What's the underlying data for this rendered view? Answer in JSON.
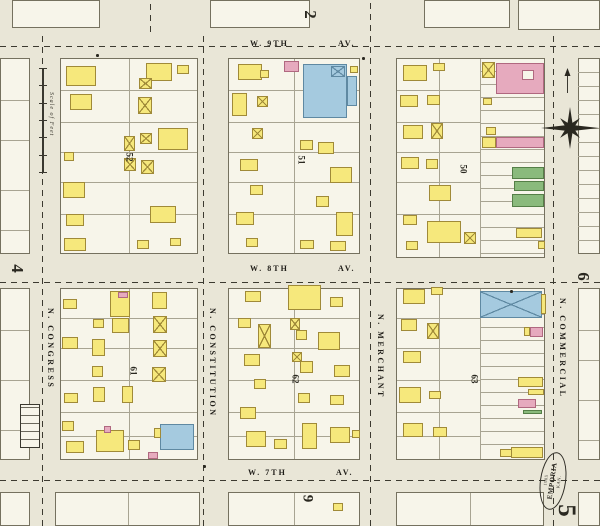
{
  "page": {
    "bg": "#e9e6d7",
    "block_fill": "#f7f5ea",
    "block_line": "#75715f",
    "lot_line": "#a8a492",
    "dash": "#3c3a30",
    "ink": "#2a2820",
    "building_colors": {
      "f": {
        "name": "frame",
        "fill": "#f6e87c",
        "border": "#a08a38"
      },
      "b": {
        "name": "brick",
        "fill": "#e6aabe",
        "border": "#b06880"
      },
      "s": {
        "name": "stone",
        "fill": "#a5cadf",
        "border": "#5f89a2"
      },
      "g": {
        "name": "special",
        "fill": "#8aba7c",
        "border": "#557f47"
      },
      "w": {
        "name": "courtyard",
        "fill": "#f7f5ea",
        "border": "#b06880"
      }
    }
  },
  "streets": {
    "horizontal": [
      {
        "name": "W. 9TH",
        "suffix": "AV.",
        "label_x": 250,
        "suffix_x": 338,
        "label_y": 39,
        "dash_y": 46
      },
      {
        "name": "W. 8TH",
        "suffix": "AV.",
        "label_x": 250,
        "suffix_x": 338,
        "label_y": 264,
        "dash_y": 282
      },
      {
        "name": "W. 7TH",
        "suffix": "AV.",
        "label_x": 248,
        "suffix_x": 336,
        "label_y": 468,
        "dash_y": 480
      }
    ],
    "vertical": [
      {
        "name": "N. CONGRESS",
        "label_x": 46,
        "label_y": 308,
        "dash_x": 42,
        "y0": 32,
        "y1": 526
      },
      {
        "name": "N. CONSTITUTION",
        "label_x": 208,
        "label_y": 308,
        "dash_x": 203,
        "y0": 32,
        "y1": 526
      },
      {
        "name": "N. MERCHANT",
        "label_x": 376,
        "label_y": 314,
        "dash_x": 370,
        "y0": 0,
        "y1": 526
      },
      {
        "name": "N. COMMERCIAL",
        "label_x": 558,
        "label_y": 298,
        "dash_x": 553,
        "y0": 32,
        "y1": 526
      }
    ],
    "extra_dashes": [
      {
        "x": 150,
        "y0": 0,
        "y1": 32
      }
    ]
  },
  "blocks": {
    "main": [
      {
        "x": 60,
        "y": 58,
        "w": 138,
        "h": 196,
        "v": [
          129
        ],
        "rows": [
          90,
          122,
          152,
          182,
          214
        ]
      },
      {
        "x": 228,
        "y": 58,
        "w": 132,
        "h": 196,
        "v": [
          294
        ],
        "rows": [
          90,
          122,
          152,
          182,
          214
        ]
      },
      {
        "x": 396,
        "y": 58,
        "w": 149,
        "h": 200,
        "v": [
          439,
          480
        ],
        "rows": [
          90,
          122,
          152,
          182,
          214
        ],
        "rows_x1": 480,
        "strip": {
          "x0": 480,
          "step": 13
        }
      },
      {
        "x": 60,
        "y": 288,
        "w": 138,
        "h": 172,
        "v": [
          129
        ],
        "rows": [
          318,
          348,
          380,
          412,
          436
        ]
      },
      {
        "x": 228,
        "y": 288,
        "w": 132,
        "h": 172,
        "v": [
          294
        ],
        "rows": [
          318,
          348,
          380,
          412,
          436
        ]
      },
      {
        "x": 396,
        "y": 288,
        "w": 149,
        "h": 172,
        "v": [
          439,
          480
        ],
        "rows": [
          318,
          348,
          380,
          412,
          436
        ],
        "rows_x1": 480,
        "strip": {
          "x0": 480,
          "step": 13
        }
      }
    ],
    "partial": [
      {
        "x": 12,
        "y": 0,
        "w": 88,
        "h": 28
      },
      {
        "x": 210,
        "y": 0,
        "w": 100,
        "h": 28
      },
      {
        "x": 424,
        "y": 0,
        "w": 86,
        "h": 28
      },
      {
        "x": 518,
        "y": 0,
        "w": 82,
        "h": 30
      },
      {
        "x": 0,
        "y": 58,
        "w": 30,
        "h": 196,
        "rows": [
          100,
          140,
          190,
          230
        ]
      },
      {
        "x": 0,
        "y": 288,
        "w": 30,
        "h": 172,
        "rows": [
          330,
          380,
          430
        ]
      },
      {
        "x": 578,
        "y": 58,
        "w": 22,
        "h": 196,
        "strip": {
          "x0": 578,
          "step": 14
        }
      },
      {
        "x": 578,
        "y": 288,
        "w": 22,
        "h": 172,
        "rows": [
          330,
          360,
          400,
          440
        ]
      },
      {
        "x": 55,
        "y": 492,
        "w": 145,
        "h": 34,
        "v": [
          128
        ]
      },
      {
        "x": 228,
        "y": 492,
        "w": 132,
        "h": 34,
        "v": [
          294
        ]
      },
      {
        "x": 396,
        "y": 492,
        "w": 148,
        "h": 34,
        "v": [
          470
        ]
      },
      {
        "x": 578,
        "y": 492,
        "w": 22,
        "h": 34
      },
      {
        "x": 0,
        "y": 492,
        "w": 30,
        "h": 34
      }
    ]
  },
  "block_numbers": [
    {
      "n": "52",
      "x": 125,
      "y": 152
    },
    {
      "n": "51",
      "x": 297,
      "y": 155
    },
    {
      "n": "50",
      "x": 459,
      "y": 164
    },
    {
      "n": "61",
      "x": 129,
      "y": 366
    },
    {
      "n": "62",
      "x": 291,
      "y": 374
    },
    {
      "n": "63",
      "x": 470,
      "y": 374
    }
  ],
  "page_numbers": [
    {
      "n": "2",
      "x": 306,
      "y": 6,
      "s": 17
    },
    {
      "n": "4",
      "x": 13,
      "y": 260,
      "s": 17
    },
    {
      "n": "6",
      "x": 579,
      "y": 268,
      "s": 17
    },
    {
      "n": "9",
      "x": 303,
      "y": 491,
      "s": 15
    },
    {
      "n": "5",
      "x": 560,
      "y": 498,
      "s": 25
    }
  ],
  "stamp": {
    "x": 540,
    "y": 452,
    "w": 26,
    "h": 58,
    "line1": "1905",
    "line2": "EMPORIA",
    "line3": "KAN."
  },
  "scale_bar": {
    "x": 42,
    "y": 68,
    "h": 104,
    "ticks": 7,
    "label": "Scale of Feet"
  },
  "compass": {
    "x": 538,
    "y": 66
  },
  "inset_table": {
    "x": 20,
    "y": 404,
    "w": 20,
    "h": 44
  },
  "corner_dots": [
    {
      "x": 96,
      "y": 54
    },
    {
      "x": 362,
      "y": 57
    },
    {
      "x": 510,
      "y": 290
    },
    {
      "x": 203,
      "y": 465
    }
  ],
  "buildings": [
    [
      66,
      66,
      30,
      20,
      "f"
    ],
    [
      70,
      94,
      22,
      16,
      "f"
    ],
    [
      64,
      152,
      10,
      9,
      "f"
    ],
    [
      63,
      182,
      22,
      16,
      "f"
    ],
    [
      66,
      214,
      18,
      12,
      "f"
    ],
    [
      64,
      238,
      22,
      13,
      "f"
    ],
    [
      146,
      63,
      26,
      18,
      "f"
    ],
    [
      177,
      65,
      12,
      9,
      "f"
    ],
    [
      139,
      78,
      13,
      11,
      "f",
      1
    ],
    [
      138,
      97,
      14,
      17,
      "f",
      1
    ],
    [
      124,
      136,
      11,
      15,
      "f",
      1
    ],
    [
      140,
      133,
      12,
      11,
      "f",
      1
    ],
    [
      124,
      158,
      12,
      13,
      "f",
      1
    ],
    [
      158,
      128,
      30,
      22,
      "f"
    ],
    [
      141,
      160,
      13,
      14,
      "f",
      1
    ],
    [
      150,
      206,
      26,
      17,
      "f"
    ],
    [
      137,
      240,
      12,
      9,
      "f"
    ],
    [
      170,
      238,
      11,
      8,
      "f"
    ],
    [
      284,
      61,
      15,
      11,
      "b"
    ],
    [
      238,
      64,
      24,
      16,
      "f"
    ],
    [
      260,
      70,
      9,
      8,
      "f"
    ],
    [
      232,
      93,
      15,
      23,
      "f"
    ],
    [
      257,
      96,
      11,
      11,
      "f",
      1
    ],
    [
      252,
      128,
      11,
      11,
      "f",
      1
    ],
    [
      240,
      159,
      18,
      12,
      "f"
    ],
    [
      250,
      185,
      13,
      10,
      "f"
    ],
    [
      236,
      212,
      18,
      13,
      "f"
    ],
    [
      246,
      238,
      12,
      9,
      "f"
    ],
    [
      303,
      64,
      44,
      54,
      "s"
    ],
    [
      347,
      76,
      10,
      30,
      "s"
    ],
    [
      331,
      66,
      14,
      11,
      "s",
      1
    ],
    [
      350,
      66,
      8,
      7,
      "f"
    ],
    [
      300,
      140,
      13,
      10,
      "f"
    ],
    [
      318,
      142,
      16,
      12,
      "f"
    ],
    [
      330,
      167,
      22,
      16,
      "f"
    ],
    [
      316,
      196,
      13,
      11,
      "f"
    ],
    [
      336,
      212,
      17,
      24,
      "f"
    ],
    [
      300,
      240,
      14,
      9,
      "f"
    ],
    [
      330,
      241,
      16,
      10,
      "f"
    ],
    [
      403,
      65,
      24,
      16,
      "f"
    ],
    [
      433,
      63,
      12,
      8,
      "f"
    ],
    [
      400,
      95,
      18,
      12,
      "f"
    ],
    [
      427,
      95,
      13,
      10,
      "f"
    ],
    [
      403,
      125,
      20,
      14,
      "f"
    ],
    [
      431,
      123,
      12,
      16,
      "f",
      1
    ],
    [
      401,
      157,
      18,
      12,
      "f"
    ],
    [
      426,
      159,
      12,
      10,
      "f"
    ],
    [
      429,
      185,
      22,
      16,
      "f"
    ],
    [
      403,
      215,
      14,
      10,
      "f"
    ],
    [
      427,
      221,
      34,
      22,
      "f"
    ],
    [
      464,
      232,
      12,
      12,
      "f",
      1
    ],
    [
      406,
      241,
      12,
      9,
      "f"
    ],
    [
      482,
      62,
      13,
      16,
      "f",
      1
    ],
    [
      496,
      63,
      48,
      31,
      "b"
    ],
    [
      522,
      70,
      12,
      10,
      "w"
    ],
    [
      483,
      98,
      9,
      7,
      "f"
    ],
    [
      486,
      127,
      10,
      8,
      "f"
    ],
    [
      482,
      137,
      14,
      11,
      "f"
    ],
    [
      496,
      137,
      48,
      11,
      "b"
    ],
    [
      512,
      167,
      32,
      12,
      "g"
    ],
    [
      514,
      181,
      30,
      10,
      "g"
    ],
    [
      512,
      194,
      32,
      13,
      "g"
    ],
    [
      516,
      228,
      26,
      10,
      "f"
    ],
    [
      538,
      241,
      7,
      8,
      "f"
    ],
    [
      110,
      291,
      20,
      26,
      "f"
    ],
    [
      118,
      292,
      10,
      6,
      "b"
    ],
    [
      112,
      318,
      17,
      15,
      "f"
    ],
    [
      93,
      319,
      11,
      9,
      "f"
    ],
    [
      92,
      339,
      13,
      17,
      "f"
    ],
    [
      92,
      366,
      11,
      11,
      "f"
    ],
    [
      93,
      387,
      12,
      15,
      "f"
    ],
    [
      63,
      299,
      14,
      10,
      "f"
    ],
    [
      62,
      337,
      16,
      12,
      "f"
    ],
    [
      64,
      393,
      14,
      10,
      "f"
    ],
    [
      62,
      421,
      12,
      10,
      "f"
    ],
    [
      66,
      441,
      18,
      12,
      "f"
    ],
    [
      152,
      292,
      15,
      17,
      "f"
    ],
    [
      153,
      316,
      14,
      17,
      "f",
      1
    ],
    [
      153,
      340,
      14,
      17,
      "f",
      1
    ],
    [
      152,
      367,
      14,
      15,
      "f",
      1
    ],
    [
      122,
      386,
      11,
      17,
      "f"
    ],
    [
      96,
      430,
      28,
      22,
      "f"
    ],
    [
      128,
      440,
      12,
      10,
      "f"
    ],
    [
      104,
      426,
      7,
      7,
      "b"
    ],
    [
      160,
      424,
      34,
      26,
      "s"
    ],
    [
      154,
      428,
      7,
      10,
      "f"
    ],
    [
      148,
      452,
      10,
      7,
      "b"
    ],
    [
      245,
      291,
      16,
      11,
      "f"
    ],
    [
      238,
      318,
      13,
      10,
      "f"
    ],
    [
      258,
      324,
      13,
      24,
      "f",
      1
    ],
    [
      244,
      354,
      16,
      12,
      "f"
    ],
    [
      254,
      379,
      12,
      10,
      "f"
    ],
    [
      240,
      407,
      16,
      12,
      "f"
    ],
    [
      246,
      431,
      20,
      16,
      "f"
    ],
    [
      274,
      439,
      13,
      10,
      "f"
    ],
    [
      288,
      285,
      33,
      25,
      "f"
    ],
    [
      330,
      297,
      13,
      10,
      "f"
    ],
    [
      290,
      318,
      10,
      12,
      "f",
      1
    ],
    [
      296,
      330,
      11,
      10,
      "f"
    ],
    [
      318,
      332,
      22,
      18,
      "f"
    ],
    [
      292,
      352,
      10,
      10,
      "f",
      1
    ],
    [
      300,
      361,
      13,
      12,
      "f"
    ],
    [
      334,
      365,
      16,
      12,
      "f"
    ],
    [
      298,
      393,
      12,
      10,
      "f"
    ],
    [
      330,
      395,
      14,
      10,
      "f"
    ],
    [
      302,
      423,
      15,
      26,
      "f"
    ],
    [
      330,
      427,
      20,
      16,
      "f"
    ],
    [
      352,
      430,
      8,
      8,
      "f"
    ],
    [
      403,
      289,
      22,
      15,
      "f"
    ],
    [
      431,
      287,
      12,
      8,
      "f"
    ],
    [
      401,
      319,
      16,
      12,
      "f"
    ],
    [
      427,
      323,
      12,
      16,
      "f",
      1
    ],
    [
      403,
      351,
      18,
      12,
      "f"
    ],
    [
      399,
      387,
      22,
      16,
      "f"
    ],
    [
      429,
      391,
      12,
      8,
      "f"
    ],
    [
      403,
      423,
      20,
      14,
      "f"
    ],
    [
      433,
      427,
      14,
      10,
      "f"
    ],
    [
      480,
      291,
      62,
      27,
      "s",
      1
    ],
    [
      541,
      294,
      5,
      20,
      "f"
    ],
    [
      524,
      327,
      6,
      9,
      "f"
    ],
    [
      530,
      327,
      13,
      10,
      "b"
    ],
    [
      518,
      377,
      25,
      10,
      "f"
    ],
    [
      528,
      389,
      16,
      6,
      "f"
    ],
    [
      518,
      399,
      18,
      9,
      "b"
    ],
    [
      523,
      410,
      19,
      4,
      "g"
    ],
    [
      511,
      447,
      32,
      11,
      "f"
    ],
    [
      500,
      449,
      12,
      8,
      "f"
    ],
    [
      333,
      503,
      10,
      8,
      "f"
    ]
  ]
}
